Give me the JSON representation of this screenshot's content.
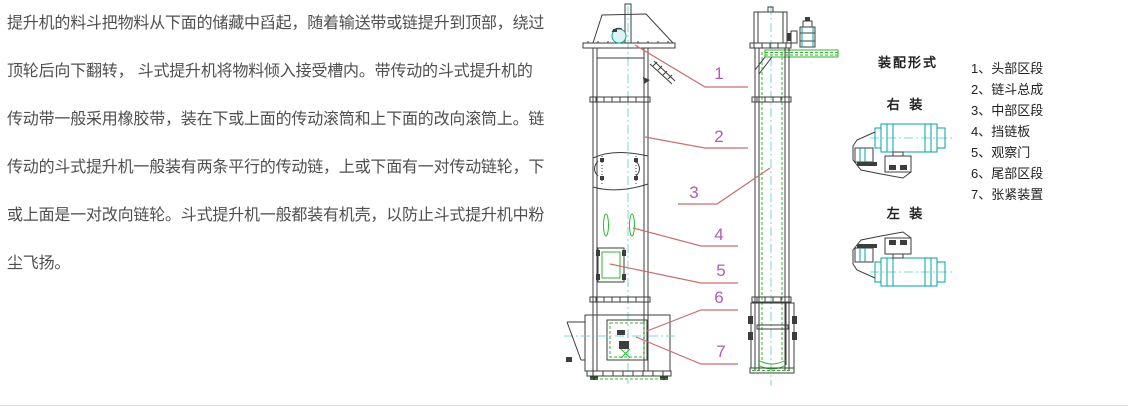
{
  "description": {
    "lines": [
      "提升机的料斗把物料从下面的储藏中舀起，随着输送带或链提升到顶部，绕过",
      "顶轮后向下翻转， 斗式提升机将物料倾入接受槽内。带传动的斗式提升机的",
      "传动带一般采用橡胶带，装在下或上面的传动滚筒和上下面的改向滚筒上。链",
      "传动的斗式提升机一般装有两条平行的传动链，上或下面有一对传动链轮，下",
      "或上面是一对改向链轮。斗式提升机一般都装有机壳，以防止斗式提升机中粉",
      "尘飞扬。"
    ]
  },
  "diagram": {
    "callouts": [
      "1",
      "2",
      "3",
      "4",
      "5",
      "6",
      "7"
    ],
    "assembly": {
      "title": "装配形式",
      "right_label": "右 装",
      "left_label": "左 装"
    },
    "legend": {
      "items": [
        "1、头部区段",
        "2、链斗总成",
        "3、中部区段",
        "4、挡链板",
        "5、观察门",
        "6、尾部区段",
        "7、张紧装置"
      ]
    },
    "colors": {
      "line": "#3d3d3d",
      "centerline": "#7fd4d4",
      "teal": "#00a3a3",
      "green": "#2eb82e",
      "leader": "#c87070",
      "callout": "#b35cb3",
      "text": "#4f4f4f",
      "legend": "#222222"
    }
  }
}
